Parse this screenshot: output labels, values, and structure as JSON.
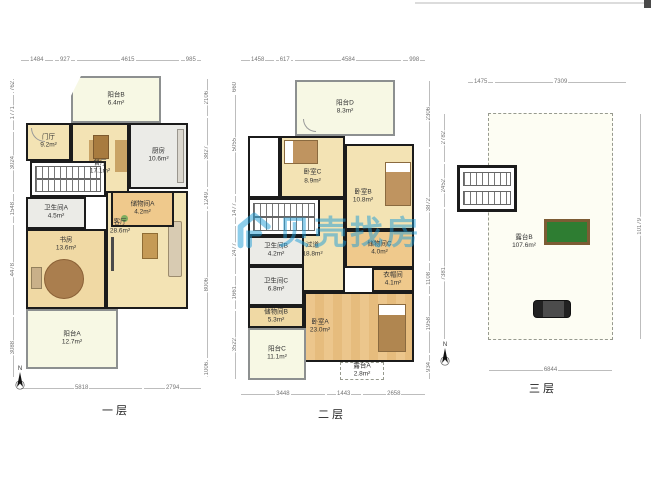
{
  "watermark": {
    "brand": "贝壳找房"
  },
  "compass": {
    "label": "N"
  },
  "floors": [
    {
      "label": "一层",
      "rooms": [
        {
          "name": "阳台B",
          "area": "6.4m²"
        },
        {
          "name": "餐厅",
          "area": "17.1m²"
        },
        {
          "name": "门厅",
          "area": "9.2m²"
        },
        {
          "name": "厨房",
          "area": "10.6m²"
        },
        {
          "name": "卫生间A",
          "area": "4.5m²"
        },
        {
          "name": "储物间A",
          "area": "4.2m²"
        },
        {
          "name": "书房",
          "area": "13.6m²"
        },
        {
          "name": "客厅",
          "area": "28.6m²"
        },
        {
          "name": "阳台A",
          "area": "12.7m²"
        }
      ],
      "dims_top": [
        "1484",
        "927",
        "4615",
        "985"
      ],
      "dims_bottom": [
        "5818",
        "2794"
      ],
      "dims_left": [
        "762",
        "1771",
        "3024",
        "1548",
        "4478",
        "3088"
      ],
      "dims_right": [
        "2106",
        "3827",
        "1249",
        "8006",
        "1006"
      ]
    },
    {
      "label": "二层",
      "rooms": [
        {
          "name": "阳台D",
          "area": "8.3m²"
        },
        {
          "name": "卧室C",
          "area": "8.9m²"
        },
        {
          "name": "卧室B",
          "area": "10.8m²"
        },
        {
          "name": "过道",
          "area": "18.8m²"
        },
        {
          "name": "卫生间B",
          "area": "4.2m²"
        },
        {
          "name": "储物间C",
          "area": "4.0m²"
        },
        {
          "name": "卫生间C",
          "area": "6.8m²"
        },
        {
          "name": "储物间B",
          "area": "5.3m²"
        },
        {
          "name": "卧室A",
          "area": "23.0m²"
        },
        {
          "name": "衣帽间",
          "area": "4.1m²"
        },
        {
          "name": "阳台C",
          "area": "11.1m²"
        },
        {
          "name": "露台A",
          "area": "2.8m²"
        }
      ],
      "dims_top": [
        "1458",
        "617",
        "4584",
        "998"
      ],
      "dims_bottom": [
        "3448",
        "1443",
        "2658"
      ],
      "dims_left": [
        "660",
        "5055",
        "1477",
        "2477",
        "1661",
        "3522"
      ],
      "dims_right": [
        "2306",
        "3872",
        "1108",
        "1958",
        "934"
      ]
    },
    {
      "label": "三层",
      "rooms": [
        {
          "name": "露台B",
          "area": "107.6m²"
        }
      ],
      "dims_top": [
        "1475",
        "7309"
      ],
      "dims_bottom": [
        "6844"
      ],
      "dims_left": [
        "2782",
        "2452",
        "7381"
      ],
      "dims_right": [
        "10179"
      ]
    }
  ]
}
